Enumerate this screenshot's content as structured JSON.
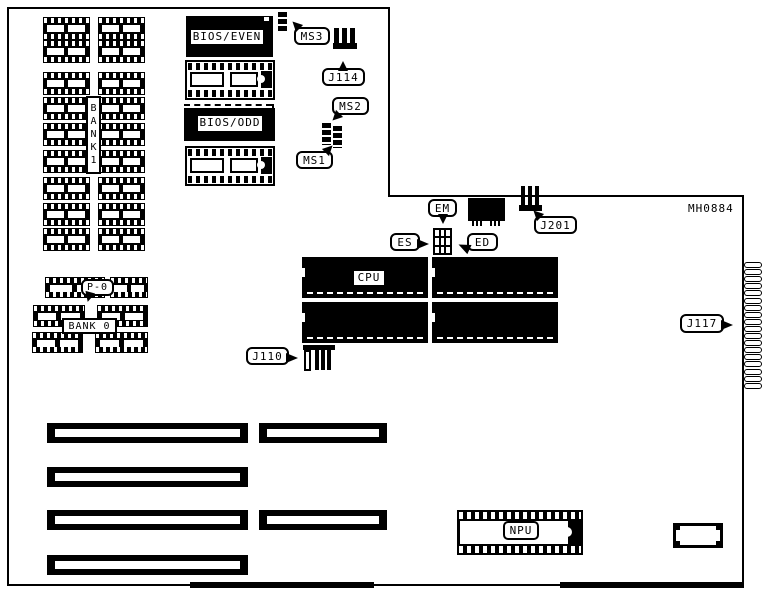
{
  "diagram": {
    "board_id": "MH0884",
    "banks": {
      "bank1": "BANK1",
      "bank0": "BANK 0"
    },
    "chips": {
      "bios_even": "BIOS/EVEN",
      "bios_odd": "BIOS/ODD",
      "cpu": "CPU",
      "npu": "NPU"
    },
    "callouts": {
      "ms3": "MS3",
      "j114": "J114",
      "ms2": "MS2",
      "ms1": "MS1",
      "em": "EM",
      "es": "ES",
      "ed": "ED",
      "j201": "J201",
      "j110": "J110",
      "j117": "J117",
      "p0": "P-0"
    }
  }
}
